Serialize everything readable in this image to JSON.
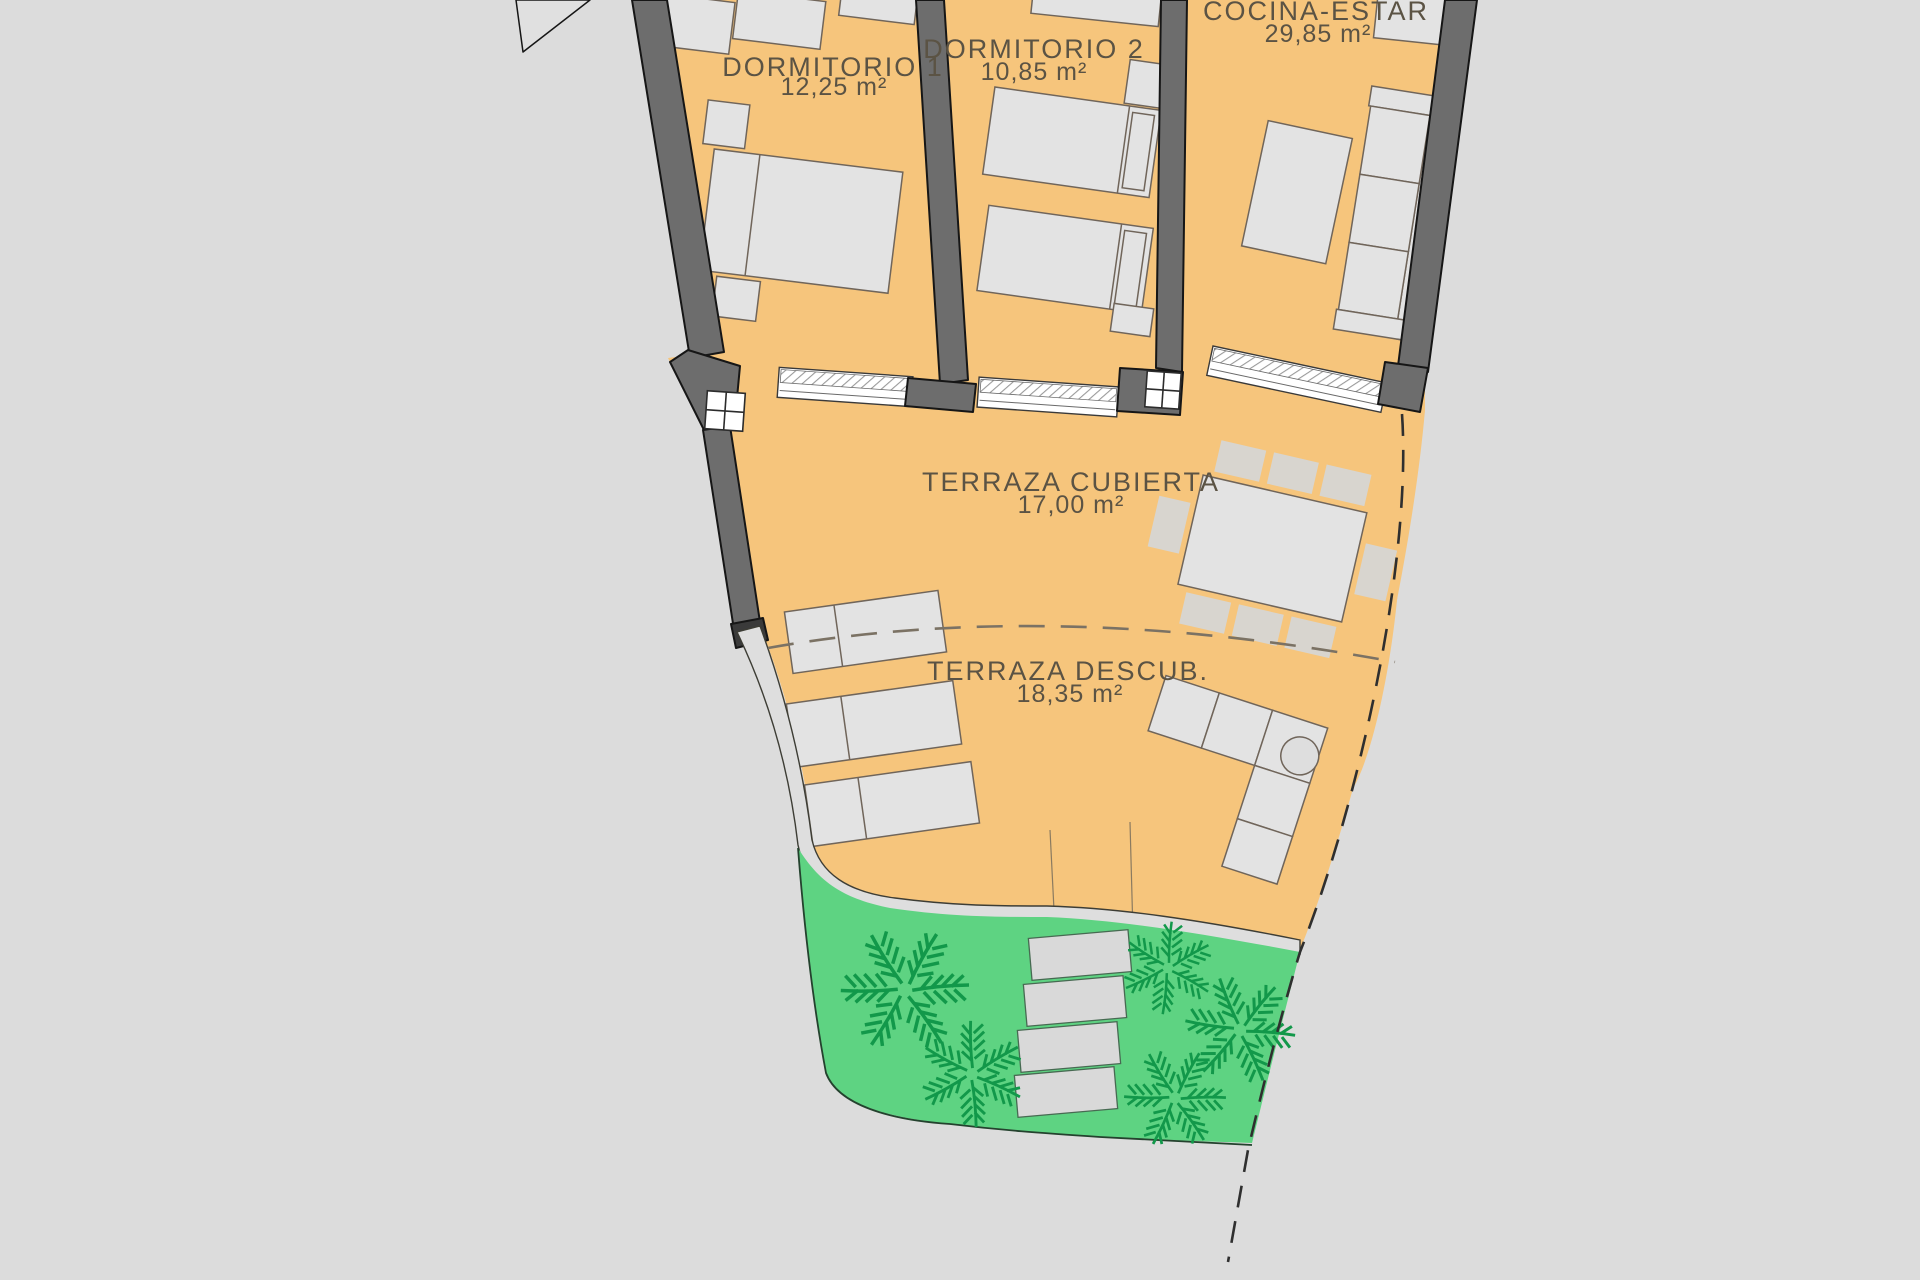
{
  "plan": {
    "type": "architectural-floor-plan",
    "rooms": [
      {
        "name": "DORMITORIO 1",
        "area": "12,25 m²"
      },
      {
        "name": "DORMITORIO 2",
        "area": "10,85 m²"
      },
      {
        "name": "COCINA-ESTAR",
        "area": "29,85 m²"
      },
      {
        "name": "TERRAZA CUBIERTA",
        "area": "17,00 m²"
      },
      {
        "name": "TERRAZA DESCUB.",
        "area": "18,35 m²"
      }
    ],
    "colors": {
      "background": "#dcdcdc",
      "floor": "#f6c57c",
      "wall": "#6d6d6d",
      "furniture": "#e3e3e3",
      "garden": "#5ed382",
      "palm": "#12984a",
      "path": "#dedede",
      "label_text": "#5b5344"
    },
    "icons": {
      "palm_tree_icon": "radiating frond strokes",
      "column_icon": "white square with 2x2 grid",
      "window_icon": "hatched glazing band"
    }
  }
}
